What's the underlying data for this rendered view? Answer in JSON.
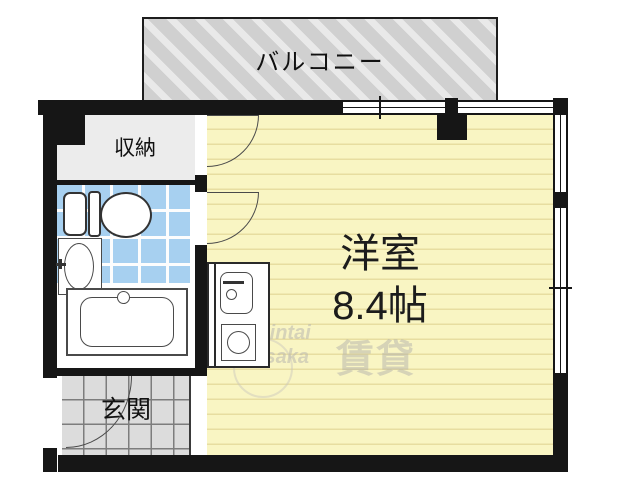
{
  "rooms": {
    "balcony": {
      "label": "バルコニー"
    },
    "storage": {
      "label": "収納"
    },
    "entrance": {
      "label": "玄関"
    },
    "main_room": {
      "label": "洋室",
      "size": "8.4帖"
    }
  },
  "fixtures": {
    "toilet": "toilet-icon",
    "wash_basin": "sink-icon",
    "bathtub": "bathtub-icon",
    "kitchen_sink": "kitchen-sink-icon",
    "stove_burner": "burner-icon"
  },
  "watermark": {
    "line1": "Chintai",
    "line2": "Osaka",
    "kanji": "賃貸"
  },
  "colors": {
    "wall": "#161616",
    "main_floor": "#f9f5c3",
    "main_floor_line": "#e7dda0",
    "bath_tile": "#a7d0f0",
    "balcony_gray": "#d0d0d0",
    "genkan_gray": "#dcdcdc",
    "storage_gray": "#ececec"
  }
}
